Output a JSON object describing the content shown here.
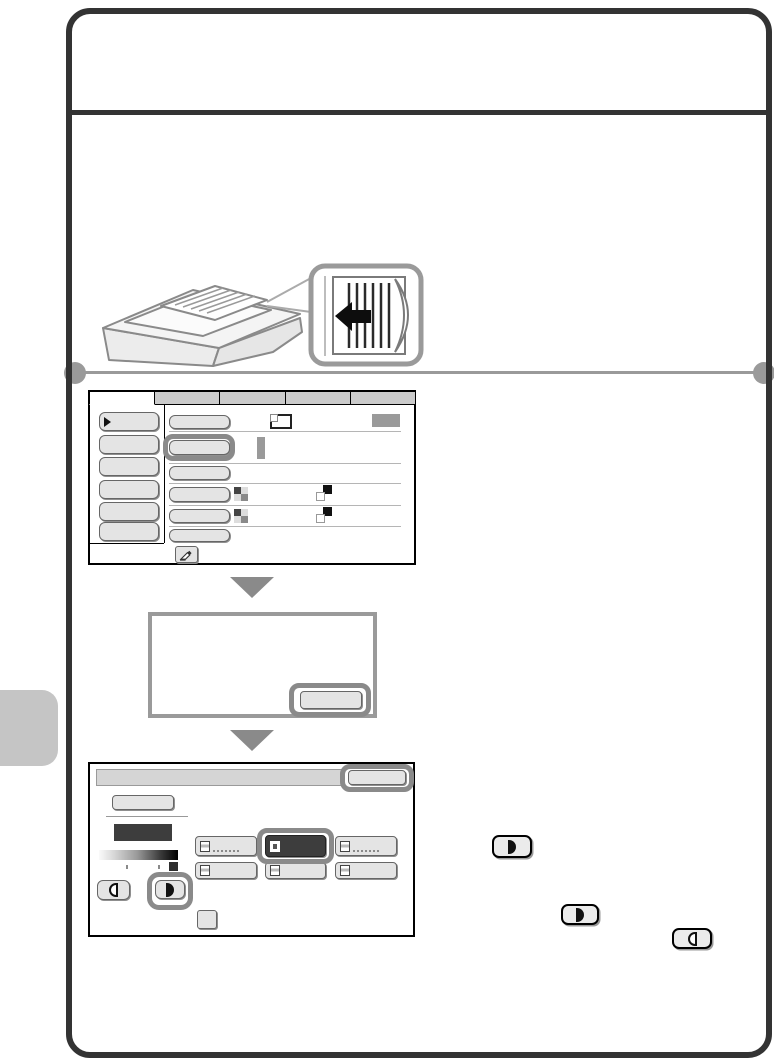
{
  "colors": {
    "page-border": "#333333",
    "rule-gray": "#9a9a9a",
    "side-tab": "#c5c5c5",
    "panel-border": "#000000",
    "tab-inactive-bg": "#cbcbcb",
    "button-bg": "#e4e4e4",
    "button-border": "#666666",
    "highlight-ring": "#8a8a8a",
    "selected-dark": "#3d3d3d",
    "triangle-gray": "#8a8a8a",
    "dialog-border": "#9a9a9a"
  },
  "illustration": {
    "machine": "multifunction-copier-top-with-document-feeder",
    "callout": "original-loaded-face-up-feed-direction",
    "arrow_direction": "left"
  },
  "icons": {
    "selection_marker": "right-triangle",
    "original": "page-with-folded-corner",
    "color_mode": "checkerboard-2x2",
    "duplex": "two-overlapping-pages",
    "job_program": "hand-with-pen",
    "lighten": "half-circle-outline-left",
    "darken": "half-circle-filled-right",
    "step_arrow": "down-triangle",
    "status_display": "gray-rectangle",
    "value_indicator": "gray-vertical-bar",
    "exposure_scale": "light-to-dark-gradient-bar"
  },
  "screen1": {
    "description": "copy-mode-settings-screen",
    "tab_count": 5,
    "active_tab_index": 0,
    "left_menu_button_count": 6,
    "setting_row_count": 6,
    "highlighted_control": "setting-row-2-button"
  },
  "message_dialog": {
    "description": "empty-message-box",
    "highlighted_control": "bottom-right-confirm-button"
  },
  "screen2": {
    "description": "exposure-settings-screen",
    "mode_button_count": 6,
    "selected_mode_index": 1,
    "highlighted_controls": [
      "ok-button",
      "darken-button",
      "selected-mode-button"
    ]
  },
  "inline_buttons": [
    {
      "icon": "darken-half-circle-filled"
    },
    {
      "icon": "darken-half-circle-filled"
    },
    {
      "icon": "lighten-half-circle-outline"
    }
  ]
}
